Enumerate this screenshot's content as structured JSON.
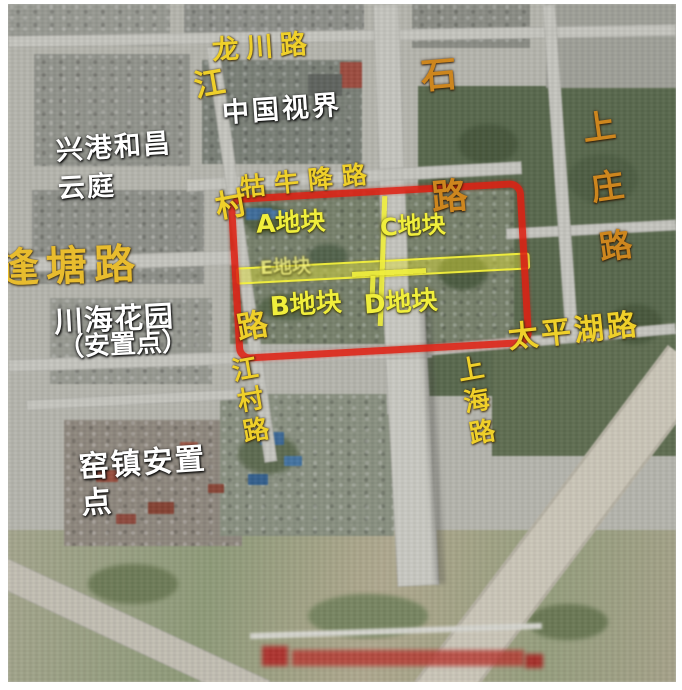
{
  "map": {
    "road_labels": {
      "longchuan": "龙川路",
      "jiangcun_long": "江村路",
      "shi_lu": "石路",
      "shangzhuang": "上庄路",
      "guniujiang": "牯牛降路",
      "fengtang": "逢塘路",
      "taipinghu": "太平湖路",
      "jiangcun": "江村路",
      "shanghai": "上海路"
    },
    "place_labels": {
      "zhongguo_shijie": "中国视界",
      "xinggang_hechang": "兴港和昌",
      "yunting": "云庭",
      "chuanhai_garden": "川海花园",
      "chuanhai_note": "（安置点）",
      "yaozhen": "窑镇安置\n点"
    },
    "plot_labels": {
      "a": "A地块",
      "b": "B地块",
      "c": "C地块",
      "d": "D地块",
      "e": "E地块"
    },
    "colors": {
      "road_yellow": "#efd02a",
      "road_orange": "#cd861e",
      "place_white": "#ffffff",
      "plot_yellow": "#f0ee3c",
      "highlight_red": "#de2012"
    }
  }
}
